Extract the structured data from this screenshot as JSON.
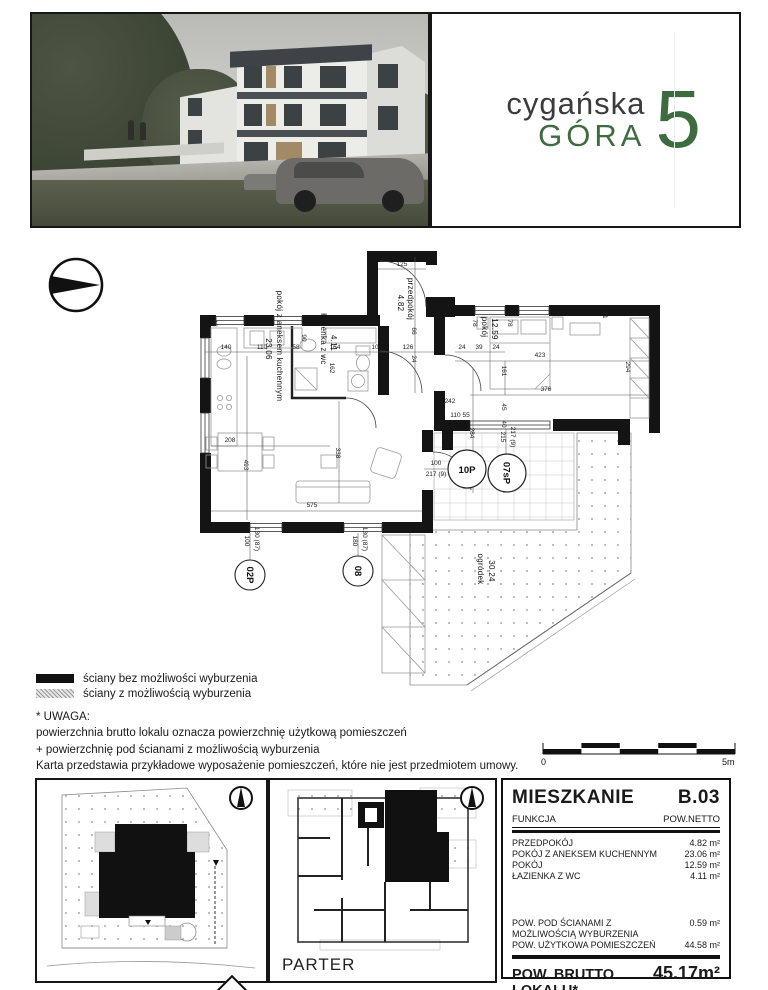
{
  "logo": {
    "line1": "cygańska",
    "line2": "GÓRA",
    "number": "5",
    "green": "#3e6b40"
  },
  "plan": {
    "rooms": {
      "living": {
        "name": "pokój z aneksem kuchennym",
        "area": "23.06"
      },
      "bath": {
        "name": "łazienka z wc",
        "area": "4.11"
      },
      "hall": {
        "name": "przedpokój",
        "area": "4.82"
      },
      "bedroom": {
        "name": "pokój",
        "area": "12.59"
      },
      "garden": {
        "name": "ogródek",
        "area": "30.24"
      }
    },
    "markers": {
      "m1": "02P",
      "m2": "08",
      "m3": "10P",
      "m4": "07sP"
    },
    "dims": [
      "125",
      "66",
      "24",
      "126",
      "24",
      "39",
      "24",
      "423",
      "376",
      "161",
      "78",
      "78",
      "21",
      "294",
      "140",
      "110",
      "58",
      "164",
      "10",
      "162",
      "90",
      "48",
      "208",
      "493",
      "338",
      "575",
      "242",
      "284",
      "110 55",
      "100",
      "217 (9)",
      "215",
      "217 (9)",
      "45",
      "40",
      "100",
      "130 (87)",
      "180",
      "130 (87)"
    ]
  },
  "legend": {
    "items": [
      {
        "label": "ściany bez możliwości wyburzenia"
      },
      {
        "label": "ściany z możliwością wyburzenia"
      }
    ]
  },
  "note": {
    "title": "* UWAGA:",
    "line1": "powierzchnia brutto lokalu oznacza powierzchnię użytkową pomieszczeń",
    "line2": "+ powierzchnię pod ścianami z możliwością wyburzenia",
    "line3": "Karta przedstawia przykładowe wyposażenie pomieszczeń, które nie jest przedmiotem umowy."
  },
  "scalebar": {
    "start": "0",
    "end": "5m"
  },
  "parter_panel": {
    "label": "PARTER"
  },
  "table": {
    "title": "MIESZKANIE",
    "unit": "B.03",
    "col1": "FUNKCJA",
    "col2": "POW.NETTO",
    "rows": [
      [
        "PRZEDPOKÓJ",
        "4.82 m²"
      ],
      [
        "POKÓJ Z ANEKSEM KUCHENNYM",
        "23.06 m²"
      ],
      [
        "POKÓJ",
        "12.59 m²"
      ],
      [
        "ŁAZIENKA Z WC",
        "4.11 m²"
      ]
    ],
    "sub_rows": [
      {
        "label": "POW. POD ŚCIANAMI Z MOŻLIWOŚCIĄ WYBURZENIA",
        "value": "0.59 m²"
      },
      {
        "label": "POW. UŻYTKOWA POMIESZCZEŃ",
        "value": "44.58 m²"
      }
    ],
    "total_label": "POW. BRUTTO LOKALU*",
    "total_value": "45.17m²",
    "garden_label": "OGRÓDEK",
    "garden_value": "30.24 m²"
  }
}
